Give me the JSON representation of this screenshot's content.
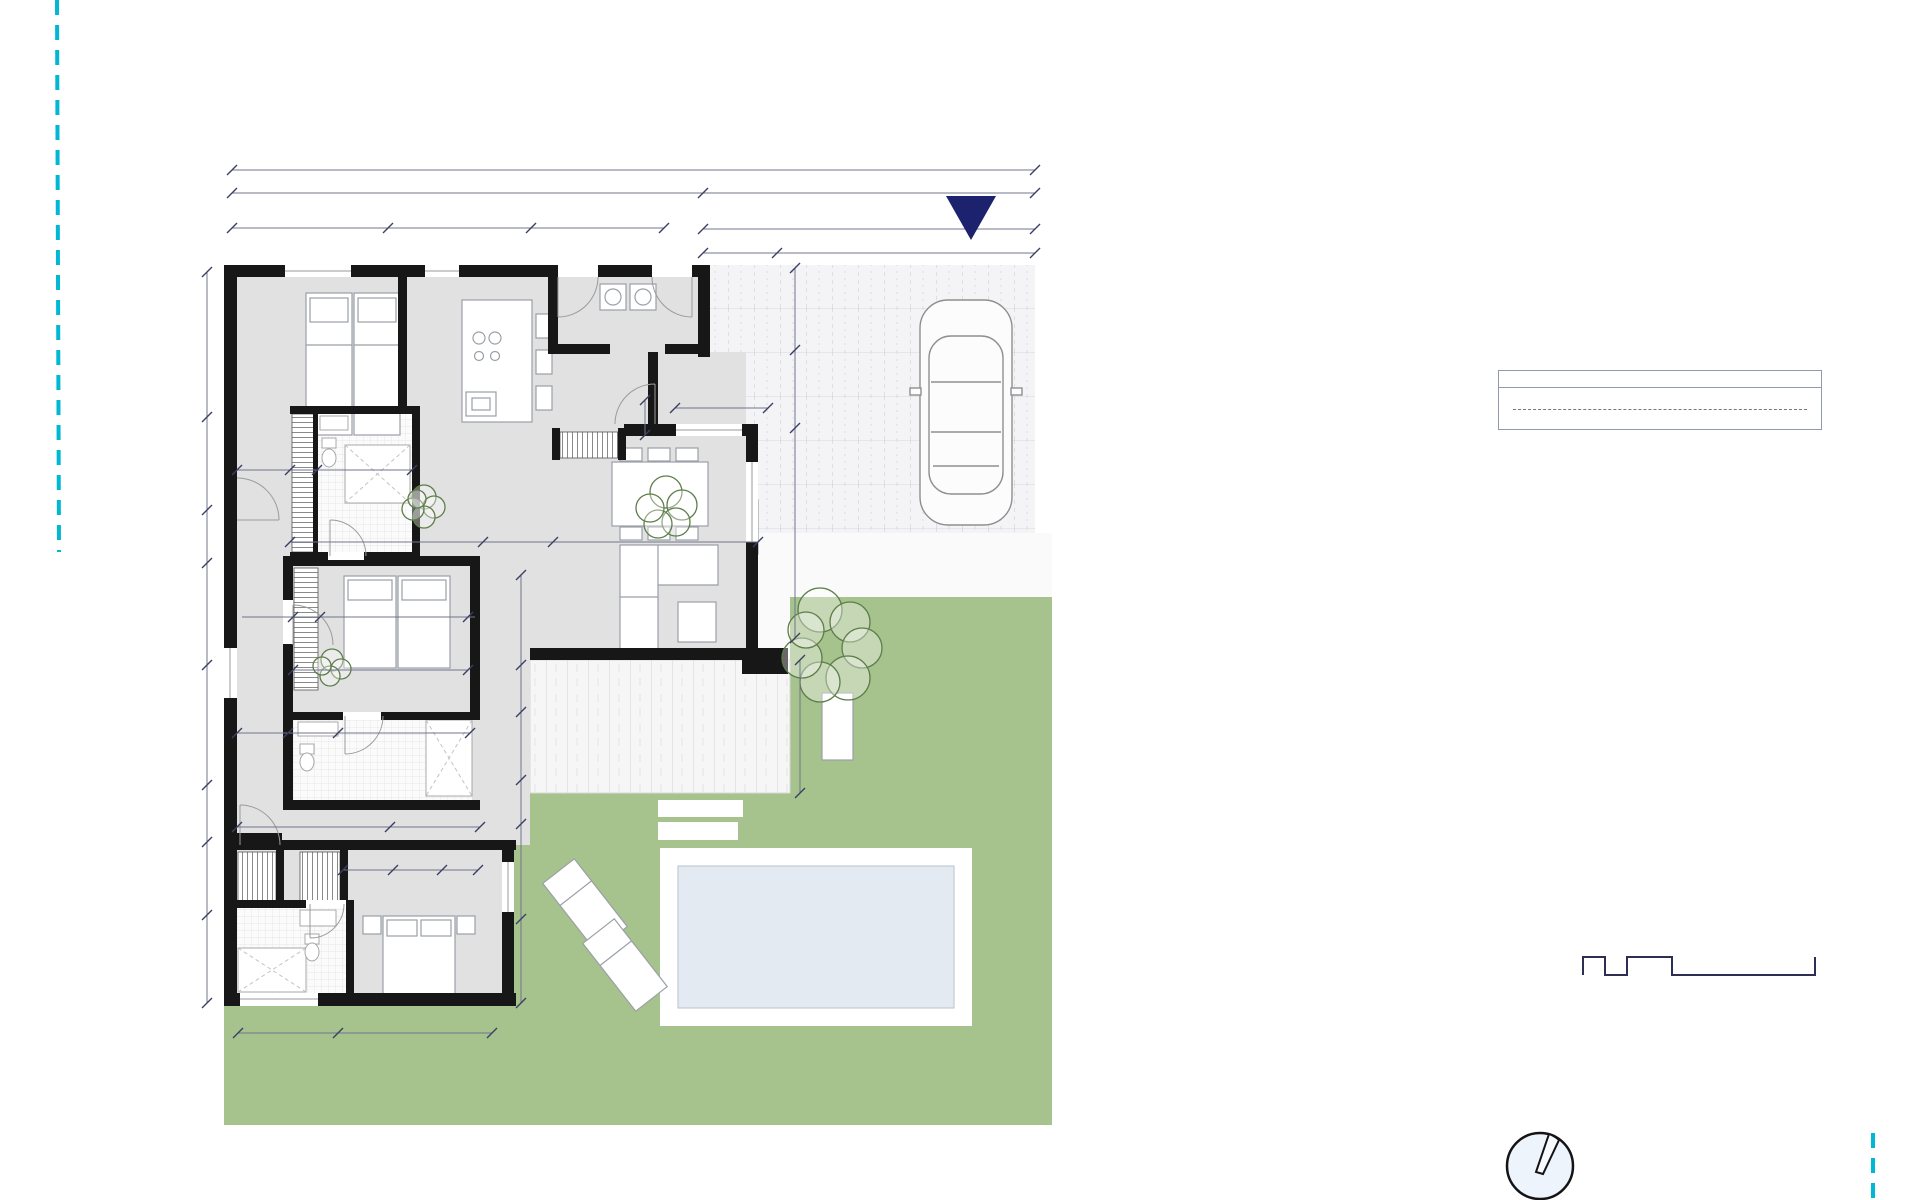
{
  "surfaces_table": {
    "title": "SURFACES VILLA SERENITY",
    "rows": [
      {
        "label": "LIVING ROOM-KITCHEN",
        "value": "43.1 m²"
      },
      {
        "label": "BEDROOM 1 (MASTER)",
        "value": "18.2 m²"
      },
      {
        "label": "BEDROOM 2",
        "value": "13.3 m²"
      },
      {
        "label": "BEDROOM 3",
        "value": "14.7 m²"
      },
      {
        "label": "BATHROOM 1",
        "value": "4.2 m²"
      },
      {
        "label": "BATHROOM 2",
        "value": "3.9 m²"
      },
      {
        "label": "BATHROOM 3",
        "value": "4.2 m²"
      },
      {
        "label": "ENTRANCE",
        "value": "2.5 m²"
      },
      {
        "label": "HALL",
        "value": "9.9 m²"
      },
      {
        "label": "UTILITY\nLAUNDRY",
        "value": "5.0 m²"
      },
      {
        "label": "TERRACE",
        "value": "20.1 m²"
      },
      {
        "label": "CAR PORT",
        "value": "43.4 m²"
      }
    ],
    "totals": [
      {
        "label": "TOTAL LIVING AREA",
        "value": "119 m²"
      },
      {
        "label": "TOTAL SURFACE",
        "value": "207.7 m²"
      },
      {
        "label": "POOL",
        "value": "18.0 m²"
      }
    ]
  },
  "plan": {
    "labels": [
      {
        "t": "17.90",
        "x": 633,
        "y": 162,
        "c": "dim"
      },
      {
        "t": "10.50",
        "x": 467,
        "y": 185,
        "c": "dim"
      },
      {
        "t": "7.40",
        "x": 869,
        "y": 185,
        "c": "dim"
      },
      {
        "t": "3.47",
        "x": 310,
        "y": 220,
        "c": "dim"
      },
      {
        "t": "3.20",
        "x": 459,
        "y": 220,
        "c": "dim"
      },
      {
        "t": "2.95",
        "x": 597,
        "y": 220,
        "c": "dim"
      },
      {
        "t": "7.39",
        "x": 869,
        "y": 221,
        "c": "dim"
      },
      {
        "t": "1.66",
        "x": 740,
        "y": 245,
        "c": "dim"
      },
      {
        "t": "5.75",
        "x": 906,
        "y": 245,
        "c": "dim"
      },
      {
        "t": "1.18",
        "x": 264,
        "y": 462,
        "c": "dim"
      },
      {
        "t": "0.60",
        "x": 303,
        "y": 462,
        "c": "dimbox"
      },
      {
        "t": "2.20",
        "x": 366,
        "y": 462,
        "c": "dim"
      },
      {
        "t": "2.01",
        "x": 721,
        "y": 400,
        "c": "dim"
      },
      {
        "t": "4.29",
        "x": 386,
        "y": 534,
        "c": "dim"
      },
      {
        "t": "1.56",
        "x": 517,
        "y": 534,
        "c": "dim"
      },
      {
        "t": "4.63",
        "x": 646,
        "y": 534,
        "c": "dim"
      },
      {
        "t": "0.60",
        "x": 306,
        "y": 609,
        "c": "dimbox"
      },
      {
        "t": "3.30",
        "x": 392,
        "y": 609,
        "c": "dim"
      },
      {
        "t": "3.90",
        "x": 380,
        "y": 662,
        "c": "dim"
      },
      {
        "t": "1.10",
        "x": 262,
        "y": 725,
        "c": "dim"
      },
      {
        "t": "1.10",
        "x": 313,
        "y": 725,
        "c": "dim"
      },
      {
        "t": "2.70",
        "x": 404,
        "y": 725,
        "c": "dim"
      },
      {
        "t": "3.40",
        "x": 315,
        "y": 819,
        "c": "dim"
      },
      {
        "t": "2.00",
        "x": 437,
        "y": 819,
        "c": "dim"
      },
      {
        "t": "1.10",
        "x": 367,
        "y": 862,
        "c": "dim"
      },
      {
        "t": "1.10",
        "x": 417,
        "y": 862,
        "c": "dim"
      },
      {
        "t": "0.80",
        "x": 461,
        "y": 862,
        "c": "dim"
      },
      {
        "t": "0.60",
        "x": 254,
        "y": 884,
        "c": "dimbox"
      },
      {
        "t": "0.60",
        "x": 323,
        "y": 884,
        "c": "dimbox"
      },
      {
        "t": "2.20",
        "x": 288,
        "y": 1026,
        "c": "dim"
      },
      {
        "t": "3.30",
        "x": 415,
        "y": 1026,
        "c": "dim"
      },
      {
        "t": "3.23",
        "x": 204,
        "y": 345,
        "c": "dimv"
      },
      {
        "t": "1.90",
        "x": 204,
        "y": 462,
        "c": "dimv"
      },
      {
        "t": "1.10",
        "x": 204,
        "y": 536,
        "c": "dimv"
      },
      {
        "t": "1.80",
        "x": 204,
        "y": 612,
        "c": "dimv"
      },
      {
        "t": "2.75",
        "x": 204,
        "y": 723,
        "c": "dimv"
      },
      {
        "t": "1.25",
        "x": 204,
        "y": 812,
        "c": "dimv"
      },
      {
        "t": "1.50",
        "x": 204,
        "y": 877,
        "c": "dimv"
      },
      {
        "t": "1.90",
        "x": 204,
        "y": 958,
        "c": "dimv"
      },
      {
        "t": "0.60",
        "x": 643,
        "y": 417,
        "c": "dimboxv"
      },
      {
        "t": "1.66",
        "x": 796,
        "y": 308,
        "c": "dimv"
      },
      {
        "t": "1.66",
        "x": 796,
        "y": 389,
        "c": "dimv"
      },
      {
        "t": "4.68",
        "x": 796,
        "y": 532,
        "c": "dimv"
      },
      {
        "t": "2.25",
        "x": 521,
        "y": 620,
        "c": "dimv"
      },
      {
        "t": "0.95",
        "x": 521,
        "y": 689,
        "c": "dimv"
      },
      {
        "t": "1.45",
        "x": 521,
        "y": 746,
        "c": "dimv"
      },
      {
        "t": "0.96",
        "x": 521,
        "y": 802,
        "c": "dimv"
      },
      {
        "t": "1.71",
        "x": 519,
        "y": 871,
        "c": "dimv"
      },
      {
        "t": "1.84",
        "x": 519,
        "y": 961,
        "c": "dimv"
      },
      {
        "t": "2.65",
        "x": 799,
        "y": 727,
        "c": "dimv"
      },
      {
        "t": "BEDROOM 3",
        "x": 283,
        "y": 346,
        "c": "room",
        "n": "room-label-bedroom3"
      },
      {
        "t": "14.7 m²",
        "x": 283,
        "y": 362,
        "c": "room",
        "n": "room-area-bedroom3"
      },
      {
        "t": "BATHROOM 3",
        "x": 374,
        "y": 432,
        "c": "room",
        "n": "room-label-bathroom3"
      },
      {
        "t": "4.2 m²",
        "x": 374,
        "y": 448,
        "c": "room",
        "n": "room-area-bathroom3"
      },
      {
        "t": "UTILITY",
        "x": 628,
        "y": 294,
        "c": "room",
        "n": "room-label-utility"
      },
      {
        "t": "LAUNDRY",
        "x": 628,
        "y": 310,
        "c": "room",
        "n": "room-label-laundry"
      },
      {
        "t": "5.0 m²",
        "x": 628,
        "y": 326,
        "c": "room",
        "n": "room-area-utility"
      },
      {
        "t": "ENTRANCE",
        "x": 620,
        "y": 383,
        "c": "room",
        "n": "room-label-entrance"
      },
      {
        "t": "2.5 m²",
        "x": 628,
        "y": 399,
        "c": "room",
        "n": "room-area-entrance"
      },
      {
        "t": "LIVING ROOM-KITCHEN",
        "x": 542,
        "y": 505,
        "c": "room",
        "n": "room-label-living"
      },
      {
        "t": "43.1 m²",
        "x": 542,
        "y": 521,
        "c": "room",
        "n": "room-area-living"
      },
      {
        "t": "HALL",
        "x": 249,
        "y": 628,
        "c": "roomv",
        "n": "room-label-hall"
      },
      {
        "t": "9.9 m²",
        "x": 265,
        "y": 628,
        "c": "roomv",
        "n": "room-area-hall"
      },
      {
        "t": "BEDROOM 2",
        "x": 378,
        "y": 684,
        "c": "room",
        "n": "room-label-bedroom2"
      },
      {
        "t": "13.3 m²",
        "x": 378,
        "y": 700,
        "c": "room",
        "n": "room-area-bedroom2"
      },
      {
        "t": "BATHROOM 2",
        "x": 352,
        "y": 751,
        "c": "room",
        "n": "room-label-bathroom2"
      },
      {
        "t": "3.9 m²",
        "x": 352,
        "y": 767,
        "c": "room",
        "n": "room-area-bathroom2"
      },
      {
        "t": "BEDROOM 1",
        "x": 412,
        "y": 885,
        "c": "room",
        "n": "room-label-bedroom1"
      },
      {
        "t": "(MASTER)",
        "x": 412,
        "y": 900,
        "c": "room",
        "n": "room-label-master"
      },
      {
        "t": "18.2 m²",
        "x": 412,
        "y": 915,
        "c": "room",
        "n": "room-area-bedroom1"
      },
      {
        "t": "BATHROOM 1",
        "x": 288,
        "y": 943,
        "c": "room",
        "n": "room-label-bathroom1"
      },
      {
        "t": "4.2 m²",
        "x": 288,
        "y": 959,
        "c": "room",
        "n": "room-area-bathroom1"
      },
      {
        "t": "3 x 6 m",
        "x": 815,
        "y": 928,
        "c": "pool",
        "n": "pool-label"
      },
      {
        "t": "ACCESS",
        "x": 971,
        "y": 183,
        "c": "access",
        "n": "access-label"
      },
      {
        "t": "SCALE: 1/100",
        "x": 1785,
        "y": 907,
        "c": "scalehdr",
        "n": "scale-label"
      },
      {
        "t": "0",
        "x": 1583,
        "y": 929,
        "c": "scalenum",
        "n": "scale-tick-0"
      },
      {
        "t": "1",
        "x": 1627,
        "y": 929,
        "c": "scalenum",
        "n": "scale-tick-1"
      },
      {
        "t": "2",
        "x": 1672,
        "y": 929,
        "c": "scalenum",
        "n": "scale-tick-2"
      },
      {
        "t": "5m",
        "x": 1813,
        "y": 929,
        "c": "scalenum",
        "n": "scale-tick-5m"
      },
      {
        "t": "N",
        "x": 1563,
        "y": 1116,
        "c": "north",
        "n": "north-label"
      }
    ]
  },
  "colors": {
    "wall": "#171717",
    "floor": "#e1e1e1",
    "lawn": "#a6c28d",
    "pool_water": "#e4eaf2",
    "dim_text": "#2b2e52",
    "accent_navy": "#1b2169",
    "boundary_cyan": "#00b7d4"
  }
}
